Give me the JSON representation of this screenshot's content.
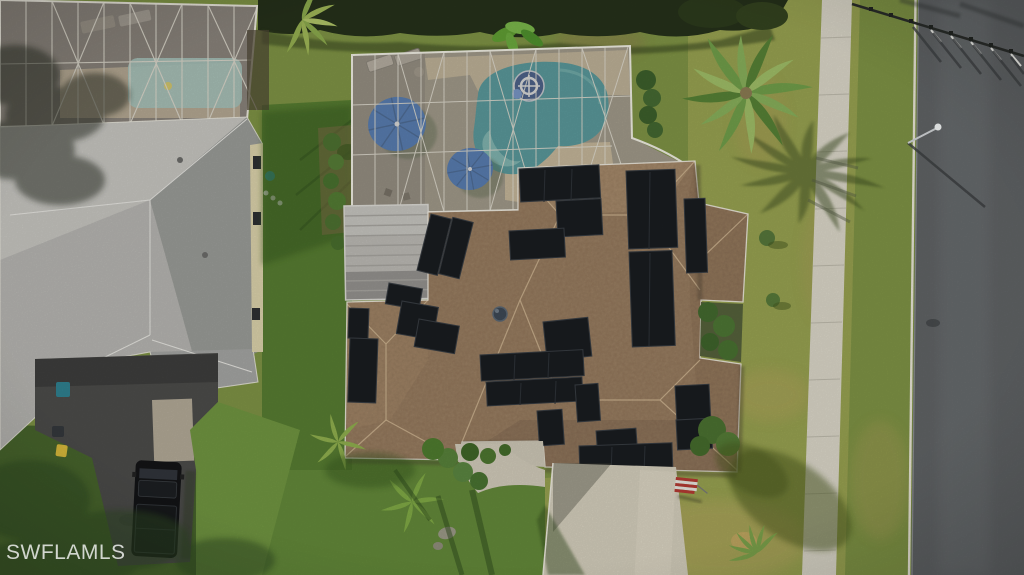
{
  "watermark": {
    "text": "SWFLAMLS"
  },
  "palette": {
    "lawn_base": "#7d9144",
    "hedge": "#25301a",
    "road": "#5f6264",
    "sidewalk": "#d8d4c6",
    "roof_left": "#b4b3af",
    "roof_main": "#9c8164",
    "lanai_roof": "#b9b7b2",
    "screen": "#a9a399",
    "pool_main": "#2f8f98",
    "pool_neighbor": "#9fd3cc",
    "deck": "#cdbb97",
    "umbrella": "#2c66b8",
    "float_toy": "#1e3f7e",
    "solar_panel": "#191c20",
    "driveway_neighbor": "#4b4b49",
    "driveway_main": "#d2ccba",
    "truck": "#131416",
    "flag_red": "#b23a33",
    "palm": "#6f9c49"
  },
  "objects": [
    "hedge-row",
    "neighbor-pool-enclosure",
    "neighbor-house-roof",
    "neighbor-driveway",
    "pickup-truck",
    "trash-bins",
    "main-pool-enclosure",
    "swimming-pool",
    "pool-float",
    "patio-umbrellas",
    "sun-loungers",
    "lanai-roof",
    "main-house-roof",
    "solar-panel-array",
    "roof-vent",
    "palm-tree",
    "palm-tree-shadow",
    "street-sidewalk",
    "street-road",
    "street-curb",
    "street-light",
    "perimeter-fence",
    "front-lawn",
    "main-driveway",
    "american-flag",
    "entry-walkway",
    "landscape-bushes",
    "watermark"
  ]
}
